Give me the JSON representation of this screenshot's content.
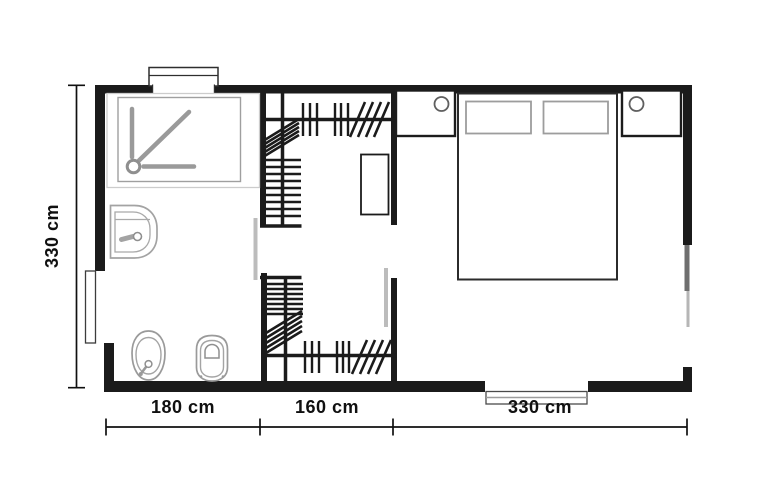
{
  "floorplan": {
    "dimensions": {
      "height_label": "330 cm",
      "bottom_labels": [
        "180 cm",
        "160 cm",
        "330 cm"
      ]
    },
    "colors": {
      "wall": "#1b1b1b",
      "dimension": "#101010",
      "fixture_outline": "#9a9a9a",
      "light_outline": "#cccccc",
      "door_leaf_dark": "#6f6f6f",
      "door_leaf_light": "#b6b6b6",
      "sliding_door": "#bcbcbc",
      "background": "#ffffff"
    },
    "rooms": [
      "bathroom",
      "walk-in-closet",
      "bedroom"
    ],
    "fixtures": [
      "shower",
      "washbasin",
      "bidet",
      "toilet",
      "wardrobe-shelves",
      "wardrobe-hanging-rail",
      "dresser",
      "double-bed",
      "pillows",
      "nightstand-left",
      "nightstand-right",
      "entry-door",
      "top-window",
      "bottom-window",
      "balcony-door",
      "closet-sliding-doors"
    ]
  }
}
